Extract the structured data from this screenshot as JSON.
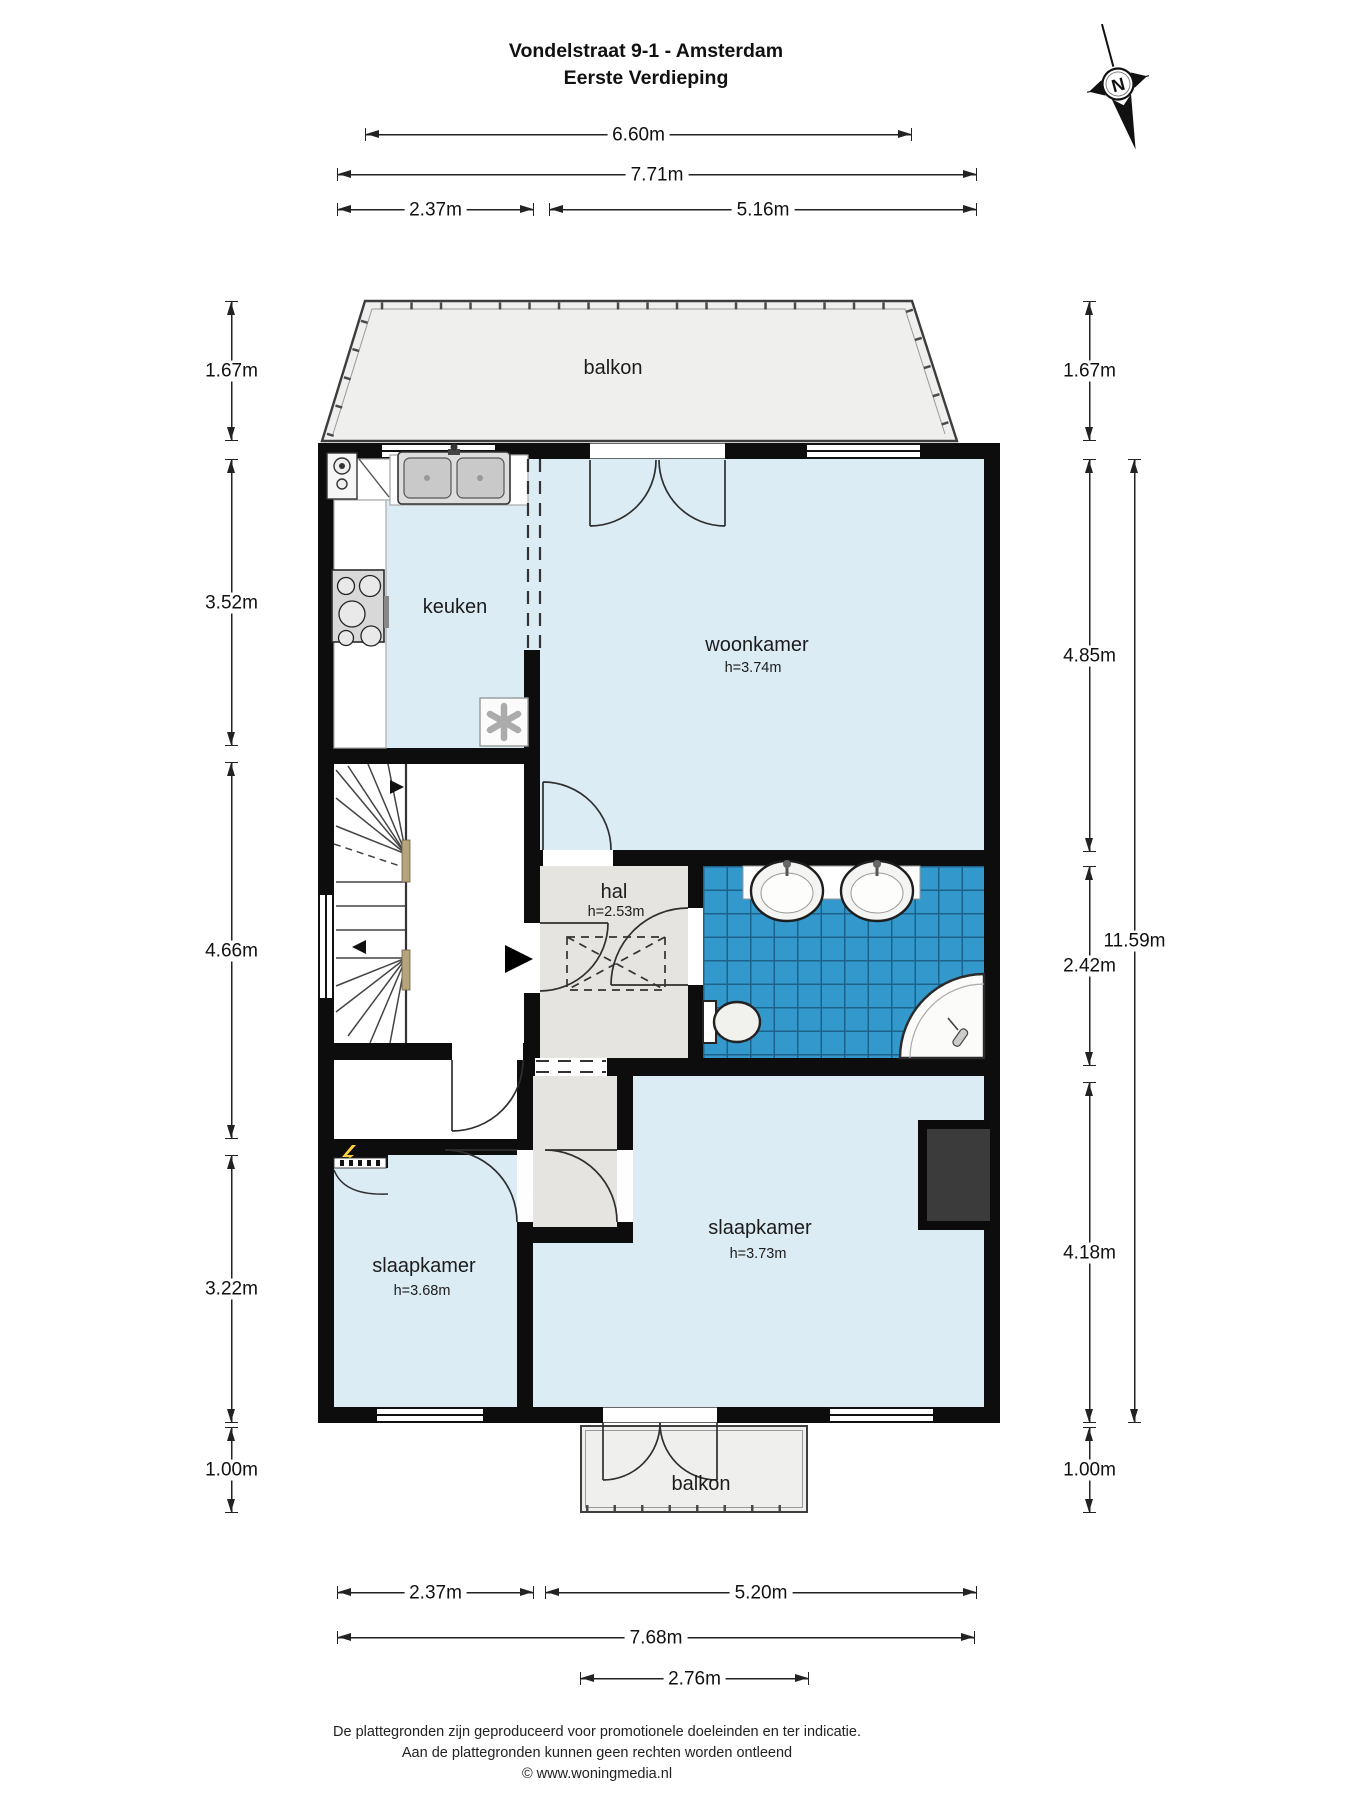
{
  "title": {
    "line1": "Vondelstraat 9-1 - Amsterdam",
    "line2": "Eerste Verdieping"
  },
  "compass": {
    "label": "N"
  },
  "rooms": {
    "balkon_top": {
      "label": "balkon"
    },
    "keuken": {
      "label": "keuken"
    },
    "woonkamer": {
      "label": "woonkamer",
      "ceiling": "h=3.74m"
    },
    "hal": {
      "label": "hal",
      "ceiling": "h=2.53m"
    },
    "slaapkamer_left": {
      "label": "slaapkamer",
      "ceiling": "h=3.68m"
    },
    "slaapkamer_right": {
      "label": "slaapkamer",
      "ceiling": "h=3.73m"
    },
    "balkon_bottom": {
      "label": "balkon"
    }
  },
  "dims": {
    "top1": "6.60m",
    "top2": "7.71m",
    "top3": "2.37m",
    "top4": "5.16m",
    "left1": "1.67m",
    "left2": "3.52m",
    "left3": "4.66m",
    "left4": "3.22m",
    "left5": "1.00m",
    "right1": "1.67m",
    "right2": "4.85m",
    "right3": "2.42m",
    "right4": "4.18m",
    "right5": "1.00m",
    "right6": "11.59m",
    "bottom1": "2.37m",
    "bottom2": "5.20m",
    "bottom3": "7.68m",
    "bottom4": "2.76m"
  },
  "footer": {
    "line1": "De plattegronden zijn geproduceerd voor promotionele doeleinden en ter indicatie.",
    "line2": "Aan de plattegronden kunnen geen rechten worden ontleend",
    "line3": "© www.woningmedia.nl"
  },
  "colors": {
    "room_blue": "#dcecf5",
    "hal_gray": "#e5e4e0",
    "balcony_gray": "#efefee",
    "tile_blue": "#3398cb",
    "tile_line": "#1c628b",
    "wall": "#0d0d0d"
  }
}
